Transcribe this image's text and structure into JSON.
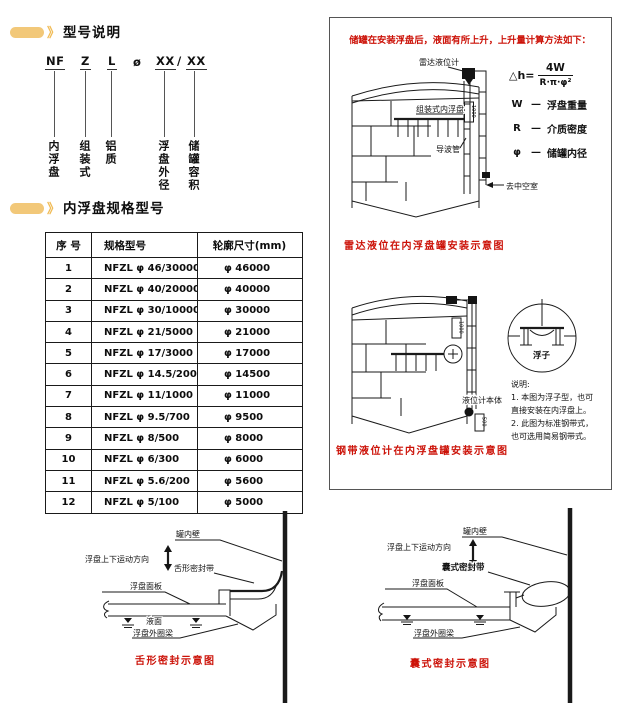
{
  "colors": {
    "accent": "#f2c879",
    "red": "#cc1208",
    "ink": "#111111"
  },
  "chevron": "》",
  "model": {
    "heading": "型号说明",
    "code": {
      "c0": "NF",
      "c1": "Z",
      "c2": "L",
      "c3": "ø",
      "c4": "XX",
      "c5": "/",
      "c6": "XX"
    },
    "labels": {
      "l0": "内浮盘",
      "l1": "组装式",
      "l2": "铝质",
      "l3": "浮盘外径",
      "l4": "储罐容积"
    }
  },
  "specs": {
    "heading": "内浮盘规格型号",
    "headers": [
      "序  号",
      "规格型号",
      "轮廓尺寸(mm)"
    ],
    "rows": [
      [
        "1",
        "NFZL φ 46/30000",
        "φ 46000"
      ],
      [
        "2",
        "NFZL φ 40/20000",
        "φ 40000"
      ],
      [
        "3",
        "NFZL φ 30/10000",
        "φ 30000"
      ],
      [
        "4",
        "NFZL φ 21/5000",
        "φ 21000"
      ],
      [
        "5",
        "NFZL φ 17/3000",
        "φ 17000"
      ],
      [
        "6",
        "NFZL φ 14.5/2000",
        "φ 14500"
      ],
      [
        "7",
        "NFZL φ 11/1000",
        "φ 11000"
      ],
      [
        "8",
        "NFZL φ 9.5/700",
        "φ 9500"
      ],
      [
        "9",
        "NFZL φ 8/500",
        "φ 8000"
      ],
      [
        "10",
        "NFZL φ 6/300",
        "φ 6000"
      ],
      [
        "11",
        "NFZL φ 5.6/200",
        "φ 5600"
      ],
      [
        "12",
        "NFZL φ 5/100",
        "φ 5000"
      ]
    ]
  },
  "panel": {
    "title": "储罐在安装浮盘后，液面有所上升，上升量计算方法如下：",
    "formula": {
      "lhs": "△h=",
      "num": "4W",
      "den": "R·π·φ²",
      "rows": [
        {
          "sym": "W",
          "dash": "—",
          "desc": "浮盘重量"
        },
        {
          "sym": "R",
          "dash": "—",
          "desc": "介质密度"
        },
        {
          "sym": "φ",
          "dash": "—",
          "desc": "储罐内径"
        }
      ]
    },
    "tank1": {
      "radar": "雷达液位计",
      "disc": "组装式内浮盘",
      "wave": "导波管",
      "chamber": "去中空室",
      "dim": "1000",
      "caption": "雷达液位在内浮盘罐安装示意图"
    },
    "tank2": {
      "float": "浮子",
      "body": "液位计本体",
      "dim": "1000",
      "dim2": "500",
      "caption": "钢带液位计在内浮盘罐安装示意图"
    },
    "notes": [
      "说明:",
      "1. 本图为浮子型，也可",
      "直接安装在内浮盘上。",
      "2. 此图为标准钢带式，",
      "也可选用简易钢带式。"
    ]
  },
  "sealTongue": {
    "wall": "罐内壁",
    "motion": "浮盘上下运动方向",
    "seal": "舌形密封带",
    "panel": "浮盘面板",
    "liquid": "液面",
    "beam": "浮盘外圈梁",
    "caption": "舌形密封示意图"
  },
  "sealBladder": {
    "wall": "罐内壁",
    "motion": "浮盘上下运动方向",
    "seal": "囊式密封带",
    "panel": "浮盘面板",
    "beam": "浮盘外圈梁",
    "caption": "囊式密封示意图"
  }
}
